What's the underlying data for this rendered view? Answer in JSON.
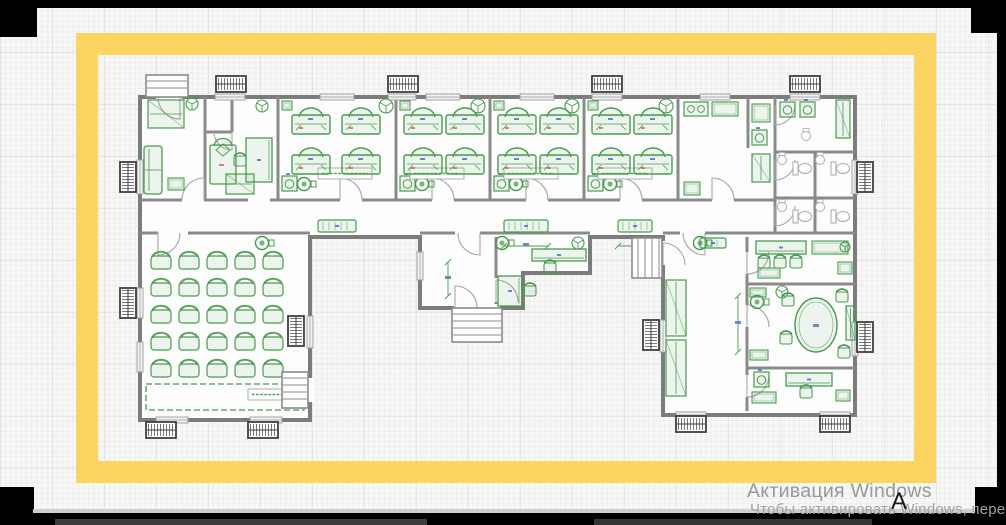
{
  "colors": {
    "accent_yellow": "#fcd462",
    "wall": "#8a8a8a",
    "wall_dark": "#7c7c7c",
    "door": "#a8a8a8",
    "green": "#4a9b4f",
    "green_fill": "rgba(92,165,98,0.10)",
    "fixture_gray": "#aeaeae",
    "radiator": "#3f3f3f",
    "dim_blue": "#5577cc",
    "dim_red": "#cc6655",
    "paper": "#fdfdfd"
  },
  "watermark": {
    "line1": "Активация Windows",
    "line2": "Чтобы активировать Windows, перей",
    "glyph": "А"
  },
  "frame": {
    "bars": [
      {
        "x": 0,
        "y": 0,
        "w": 1006,
        "h": 8,
        "c": "#000000"
      },
      {
        "x": 0,
        "y": 0,
        "w": 37,
        "h": 37,
        "c": "#000000"
      },
      {
        "x": 971,
        "y": 0,
        "w": 35,
        "h": 33,
        "c": "#000000"
      },
      {
        "x": 997,
        "y": 0,
        "w": 9,
        "h": 525,
        "c": "#000000"
      },
      {
        "x": 975,
        "y": 487,
        "w": 31,
        "h": 38,
        "c": "#000000"
      },
      {
        "x": 0,
        "y": 487,
        "w": 34,
        "h": 38,
        "c": "#000000"
      },
      {
        "x": 33,
        "y": 509,
        "w": 942,
        "h": 4,
        "c": "#cfcfcf"
      },
      {
        "x": 0,
        "y": 513,
        "w": 1006,
        "h": 12,
        "c": "#000000"
      },
      {
        "x": 55,
        "y": 519,
        "w": 372,
        "h": 6,
        "c": "#3d3d3d"
      },
      {
        "x": 594,
        "y": 519,
        "w": 278,
        "h": 6,
        "c": "#343434"
      }
    ]
  },
  "plan": {
    "outline": "140,97 855,97 855,415 663,415 663,237 590,237 590,273 523,273 523,308 420,308 420,237 310,237 310,420 140,420",
    "walls": [
      [
        205,
        97,
        205,
        200
      ],
      [
        278,
        97,
        278,
        200
      ],
      [
        396,
        97,
        396,
        200
      ],
      [
        490,
        97,
        490,
        200
      ],
      [
        584,
        97,
        584,
        200
      ],
      [
        678,
        97,
        678,
        200
      ],
      [
        748,
        97,
        748,
        148
      ],
      [
        775,
        97,
        775,
        233
      ],
      [
        815,
        152,
        815,
        233
      ],
      [
        775,
        152,
        855,
        152
      ],
      [
        775,
        198,
        855,
        198
      ],
      [
        775,
        233,
        855,
        233
      ],
      [
        232,
        97,
        232,
        132
      ],
      [
        205,
        132,
        232,
        132
      ],
      [
        140,
        200,
        182,
        200
      ],
      [
        204,
        200,
        248,
        200
      ],
      [
        270,
        200,
        340,
        200
      ],
      [
        362,
        200,
        432,
        200
      ],
      [
        454,
        200,
        526,
        200
      ],
      [
        548,
        200,
        620,
        200
      ],
      [
        642,
        200,
        712,
        200
      ],
      [
        734,
        200,
        775,
        200
      ],
      [
        140,
        233,
        158,
        233
      ],
      [
        188,
        233,
        310,
        233
      ],
      [
        420,
        233,
        455,
        233
      ],
      [
        480,
        233,
        590,
        233
      ],
      [
        663,
        233,
        680,
        233
      ],
      [
        705,
        233,
        775,
        233
      ],
      [
        496,
        237,
        496,
        278
      ],
      [
        496,
        302,
        496,
        308
      ],
      [
        747,
        237,
        747,
        252
      ],
      [
        747,
        274,
        747,
        305
      ],
      [
        747,
        327,
        747,
        375
      ],
      [
        747,
        397,
        747,
        411
      ],
      [
        747,
        284,
        855,
        284
      ],
      [
        747,
        368,
        855,
        368
      ]
    ],
    "gaps": [
      [
        659,
        241,
        8,
        24
      ],
      [
        306,
        378,
        8,
        24
      ],
      [
        156,
        93,
        26,
        8
      ],
      [
        454,
        304,
        46,
        8
      ]
    ],
    "windows": [
      [
        215,
        94,
        30,
        6
      ],
      [
        320,
        94,
        34,
        6
      ],
      [
        388,
        94,
        28,
        6
      ],
      [
        426,
        94,
        34,
        6
      ],
      [
        520,
        94,
        34,
        6
      ],
      [
        592,
        94,
        30,
        6
      ],
      [
        700,
        94,
        30,
        6
      ],
      [
        790,
        94,
        30,
        6
      ],
      [
        137,
        160,
        6,
        34
      ],
      [
        137,
        288,
        6,
        30
      ],
      [
        137,
        342,
        6,
        30
      ],
      [
        852,
        160,
        6,
        34
      ],
      [
        852,
        322,
        6,
        34
      ],
      [
        307,
        316,
        6,
        32
      ],
      [
        660,
        320,
        6,
        32
      ],
      [
        417,
        252,
        6,
        28
      ],
      [
        156,
        417,
        32,
        6
      ],
      [
        250,
        417,
        32,
        6
      ],
      [
        676,
        412,
        30,
        6
      ],
      [
        820,
        412,
        30,
        6
      ]
    ],
    "radiators": [
      [
        216,
        76,
        30,
        16
      ],
      [
        388,
        76,
        30,
        16
      ],
      [
        592,
        76,
        30,
        16
      ],
      [
        790,
        76,
        30,
        16
      ],
      [
        120,
        162,
        16,
        30
      ],
      [
        120,
        288,
        16,
        30
      ],
      [
        288,
        316,
        16,
        30
      ],
      [
        857,
        162,
        16,
        30
      ],
      [
        857,
        322,
        16,
        30
      ],
      [
        643,
        320,
        16,
        30
      ],
      [
        146,
        422,
        30,
        16
      ],
      [
        248,
        422,
        30,
        16
      ],
      [
        676,
        416,
        30,
        16
      ],
      [
        820,
        416,
        30,
        16
      ]
    ],
    "stairs": [
      [
        146,
        75,
        42,
        22,
        "h"
      ],
      [
        452,
        308,
        50,
        34,
        "h"
      ],
      [
        282,
        372,
        26,
        36,
        "h"
      ],
      [
        632,
        238,
        30,
        40,
        "v"
      ]
    ],
    "doors": [
      [
        204,
        200,
        22,
        -90,
        180,
        0
      ],
      [
        340,
        200,
        22,
        -90,
        0,
        1
      ],
      [
        432,
        200,
        22,
        -90,
        0,
        1
      ],
      [
        526,
        200,
        22,
        -90,
        0,
        1
      ],
      [
        620,
        200,
        22,
        -90,
        0,
        1
      ],
      [
        712,
        200,
        22,
        -90,
        0,
        1
      ],
      [
        158,
        233,
        22,
        90,
        0,
        0
      ],
      [
        480,
        233,
        22,
        90,
        180,
        1
      ],
      [
        496,
        302,
        22,
        -90,
        0,
        1
      ],
      [
        705,
        233,
        22,
        90,
        180,
        1
      ],
      [
        747,
        252,
        22,
        90,
        0,
        0
      ],
      [
        747,
        327,
        22,
        -90,
        0,
        1
      ],
      [
        747,
        375,
        22,
        90,
        0,
        0
      ],
      [
        775,
        160,
        20,
        90,
        0,
        0
      ],
      [
        775,
        206,
        20,
        90,
        0,
        0
      ],
      [
        775,
        105,
        20,
        90,
        0,
        0
      ],
      [
        455,
        308,
        22,
        -90,
        0,
        1
      ],
      [
        663,
        265,
        22,
        -90,
        0,
        1
      ],
      [
        307,
        378,
        24,
        90,
        180,
        1
      ],
      [
        180,
        97,
        22,
        90,
        180,
        1
      ],
      [
        232,
        132,
        18,
        90,
        180,
        1
      ]
    ],
    "beds": [
      [
        292,
        104
      ],
      [
        342,
        104
      ],
      [
        292,
        144
      ],
      [
        342,
        144
      ],
      [
        404,
        104
      ],
      [
        446,
        104
      ],
      [
        404,
        144
      ],
      [
        446,
        144
      ],
      [
        498,
        104
      ],
      [
        540,
        104
      ],
      [
        498,
        144
      ],
      [
        540,
        144
      ],
      [
        592,
        104
      ],
      [
        634,
        104
      ],
      [
        592,
        144
      ],
      [
        634,
        144
      ]
    ],
    "hall_chairs": {
      "x0": 150,
      "y0": 250,
      "dx": 28,
      "dy": 27,
      "cols": 5,
      "rows": 5,
      "w": 22,
      "h": 19
    },
    "items": [
      {
        "t": "ward",
        "x": 148,
        "y": 100,
        "w": 36,
        "h": 28
      },
      {
        "t": "sofa",
        "x": 144,
        "y": 146,
        "w": 18,
        "h": 48
      },
      {
        "t": "tbl",
        "x": 168,
        "y": 178,
        "w": 16,
        "h": 12
      },
      {
        "t": "fan",
        "x": 192,
        "y": 104,
        "r": 6
      },
      {
        "t": "bedv",
        "x": 210,
        "y": 136
      },
      {
        "t": "desk",
        "x": 246,
        "y": 138,
        "w": 26,
        "h": 44,
        "o": "v"
      },
      {
        "t": "chr",
        "x": 240,
        "y": 160
      },
      {
        "t": "ward",
        "x": 226,
        "y": 174,
        "w": 28,
        "h": 20
      },
      {
        "t": "fan",
        "x": 262,
        "y": 106,
        "r": 6
      },
      {
        "t": "wash",
        "x": 282,
        "y": 176
      },
      {
        "t": "pump",
        "x": 304,
        "y": 184
      },
      {
        "t": "wash",
        "x": 400,
        "y": 176
      },
      {
        "t": "pump",
        "x": 422,
        "y": 184
      },
      {
        "t": "wash",
        "x": 494,
        "y": 176
      },
      {
        "t": "pump",
        "x": 516,
        "y": 184
      },
      {
        "t": "wash",
        "x": 588,
        "y": 176
      },
      {
        "t": "pump",
        "x": 610,
        "y": 184
      },
      {
        "t": "tbl",
        "x": 282,
        "y": 101,
        "w": 10,
        "h": 9
      },
      {
        "t": "tbl",
        "x": 400,
        "y": 101,
        "w": 10,
        "h": 9
      },
      {
        "t": "tbl",
        "x": 494,
        "y": 101,
        "w": 10,
        "h": 9
      },
      {
        "t": "tbl",
        "x": 588,
        "y": 101,
        "w": 10,
        "h": 9
      },
      {
        "t": "fan",
        "x": 386,
        "y": 106,
        "r": 7
      },
      {
        "t": "fan",
        "x": 478,
        "y": 106,
        "r": 7
      },
      {
        "t": "fan",
        "x": 572,
        "y": 106,
        "r": 7
      },
      {
        "t": "fan",
        "x": 666,
        "y": 106,
        "r": 7
      },
      {
        "t": "label",
        "x": 318,
        "y": 168,
        "w": 54,
        "h": 11
      },
      {
        "t": "label",
        "x": 410,
        "y": 168,
        "w": 54,
        "h": 11
      },
      {
        "t": "label",
        "x": 504,
        "y": 168,
        "w": 54,
        "h": 11
      },
      {
        "t": "label",
        "x": 598,
        "y": 168,
        "w": 54,
        "h": 11
      },
      {
        "t": "stove",
        "x": 684,
        "y": 102,
        "w": 24,
        "h": 14
      },
      {
        "t": "tbl",
        "x": 712,
        "y": 102,
        "w": 26,
        "h": 14
      },
      {
        "t": "tbl",
        "x": 752,
        "y": 104,
        "w": 18,
        "h": 18
      },
      {
        "t": "wash",
        "x": 752,
        "y": 130
      },
      {
        "t": "ward",
        "x": 752,
        "y": 154,
        "w": 18,
        "h": 28
      },
      {
        "t": "tbl",
        "x": 684,
        "y": 182,
        "w": 16,
        "h": 13
      },
      {
        "t": "wash",
        "x": 780,
        "y": 102
      },
      {
        "t": "wash",
        "x": 800,
        "y": 102
      },
      {
        "t": "ward",
        "x": 836,
        "y": 100,
        "w": 14,
        "h": 38
      },
      {
        "t": "gsink",
        "x": 806,
        "y": 136
      },
      {
        "t": "gsink",
        "x": 782,
        "y": 160
      },
      {
        "t": "gsink",
        "x": 820,
        "y": 160
      },
      {
        "t": "wc",
        "x": 793,
        "y": 162
      },
      {
        "t": "wc",
        "x": 831,
        "y": 162
      },
      {
        "t": "gsink",
        "x": 782,
        "y": 207
      },
      {
        "t": "gsink",
        "x": 820,
        "y": 207
      },
      {
        "t": "wc",
        "x": 793,
        "y": 210
      },
      {
        "t": "wc",
        "x": 831,
        "y": 210
      },
      {
        "t": "bench",
        "x": 318,
        "y": 220,
        "w": 38,
        "h": 12
      },
      {
        "t": "bench",
        "x": 504,
        "y": 220,
        "w": 44,
        "h": 12
      },
      {
        "t": "bench",
        "x": 618,
        "y": 220,
        "w": 34,
        "h": 12
      },
      {
        "t": "pump",
        "x": 262,
        "y": 243
      },
      {
        "t": "pump",
        "x": 700,
        "y": 243
      },
      {
        "t": "dim",
        "x1": 504,
        "y1": 246,
        "x2": 548,
        "y2": 246
      },
      {
        "t": "dim",
        "x1": 618,
        "y1": 246,
        "x2": 652,
        "y2": 246
      },
      {
        "t": "stage",
        "x": 146,
        "y": 384,
        "w": 158,
        "h": 26
      },
      {
        "t": "label",
        "x": 248,
        "y": 389,
        "w": 56,
        "h": 11
      },
      {
        "t": "desk",
        "x": 532,
        "y": 249,
        "w": 54,
        "h": 12,
        "o": "h"
      },
      {
        "t": "chr",
        "x": 550,
        "y": 267
      },
      {
        "t": "desk",
        "x": 498,
        "y": 276,
        "w": 24,
        "h": 30,
        "o": "v"
      },
      {
        "t": "chr",
        "x": 530,
        "y": 290
      },
      {
        "t": "fan",
        "x": 578,
        "y": 243,
        "r": 6
      },
      {
        "t": "pump",
        "x": 502,
        "y": 243
      },
      {
        "t": "dim",
        "x1": 448,
        "y1": 262,
        "x2": 448,
        "y2": 296
      },
      {
        "t": "ward",
        "x": 666,
        "y": 280,
        "w": 20,
        "h": 56
      },
      {
        "t": "ward",
        "x": 666,
        "y": 340,
        "w": 20,
        "h": 56
      },
      {
        "t": "bench",
        "x": 700,
        "y": 238,
        "w": 26,
        "h": 10
      },
      {
        "t": "dim",
        "x1": 738,
        "y1": 296,
        "x2": 738,
        "y2": 352
      },
      {
        "t": "desk",
        "x": 756,
        "y": 241,
        "w": 50,
        "h": 13,
        "o": "h"
      },
      {
        "t": "chr",
        "x": 764,
        "y": 262
      },
      {
        "t": "chr",
        "x": 780,
        "y": 262
      },
      {
        "t": "chr",
        "x": 796,
        "y": 262
      },
      {
        "t": "tbl",
        "x": 812,
        "y": 241,
        "w": 36,
        "h": 13
      },
      {
        "t": "tbl",
        "x": 838,
        "y": 262,
        "w": 14,
        "h": 12
      },
      {
        "t": "tbl",
        "x": 758,
        "y": 268,
        "w": 22,
        "h": 10
      },
      {
        "t": "fan",
        "x": 845,
        "y": 247,
        "r": 5
      },
      {
        "t": "oval",
        "x": 816,
        "y": 325,
        "rx": 21,
        "ry": 27
      },
      {
        "t": "chr",
        "x": 788,
        "y": 300
      },
      {
        "t": "chr",
        "x": 786,
        "y": 338
      },
      {
        "t": "chr",
        "x": 842,
        "y": 296
      },
      {
        "t": "chr",
        "x": 844,
        "y": 352
      },
      {
        "t": "tbl",
        "x": 750,
        "y": 288,
        "w": 16,
        "h": 9
      },
      {
        "t": "fan",
        "x": 782,
        "y": 292,
        "r": 6
      },
      {
        "t": "ward",
        "x": 846,
        "y": 306,
        "w": 9,
        "h": 34
      },
      {
        "t": "tbl",
        "x": 750,
        "y": 350,
        "w": 18,
        "h": 10
      },
      {
        "t": "pump",
        "x": 757,
        "y": 302
      },
      {
        "t": "desk",
        "x": 786,
        "y": 373,
        "w": 46,
        "h": 13,
        "o": "h"
      },
      {
        "t": "chr",
        "x": 806,
        "y": 392
      },
      {
        "t": "tbl",
        "x": 752,
        "y": 392,
        "w": 24,
        "h": 11
      },
      {
        "t": "wash",
        "x": 754,
        "y": 372
      },
      {
        "t": "tbl",
        "x": 836,
        "y": 390,
        "w": 14,
        "h": 11
      }
    ]
  }
}
